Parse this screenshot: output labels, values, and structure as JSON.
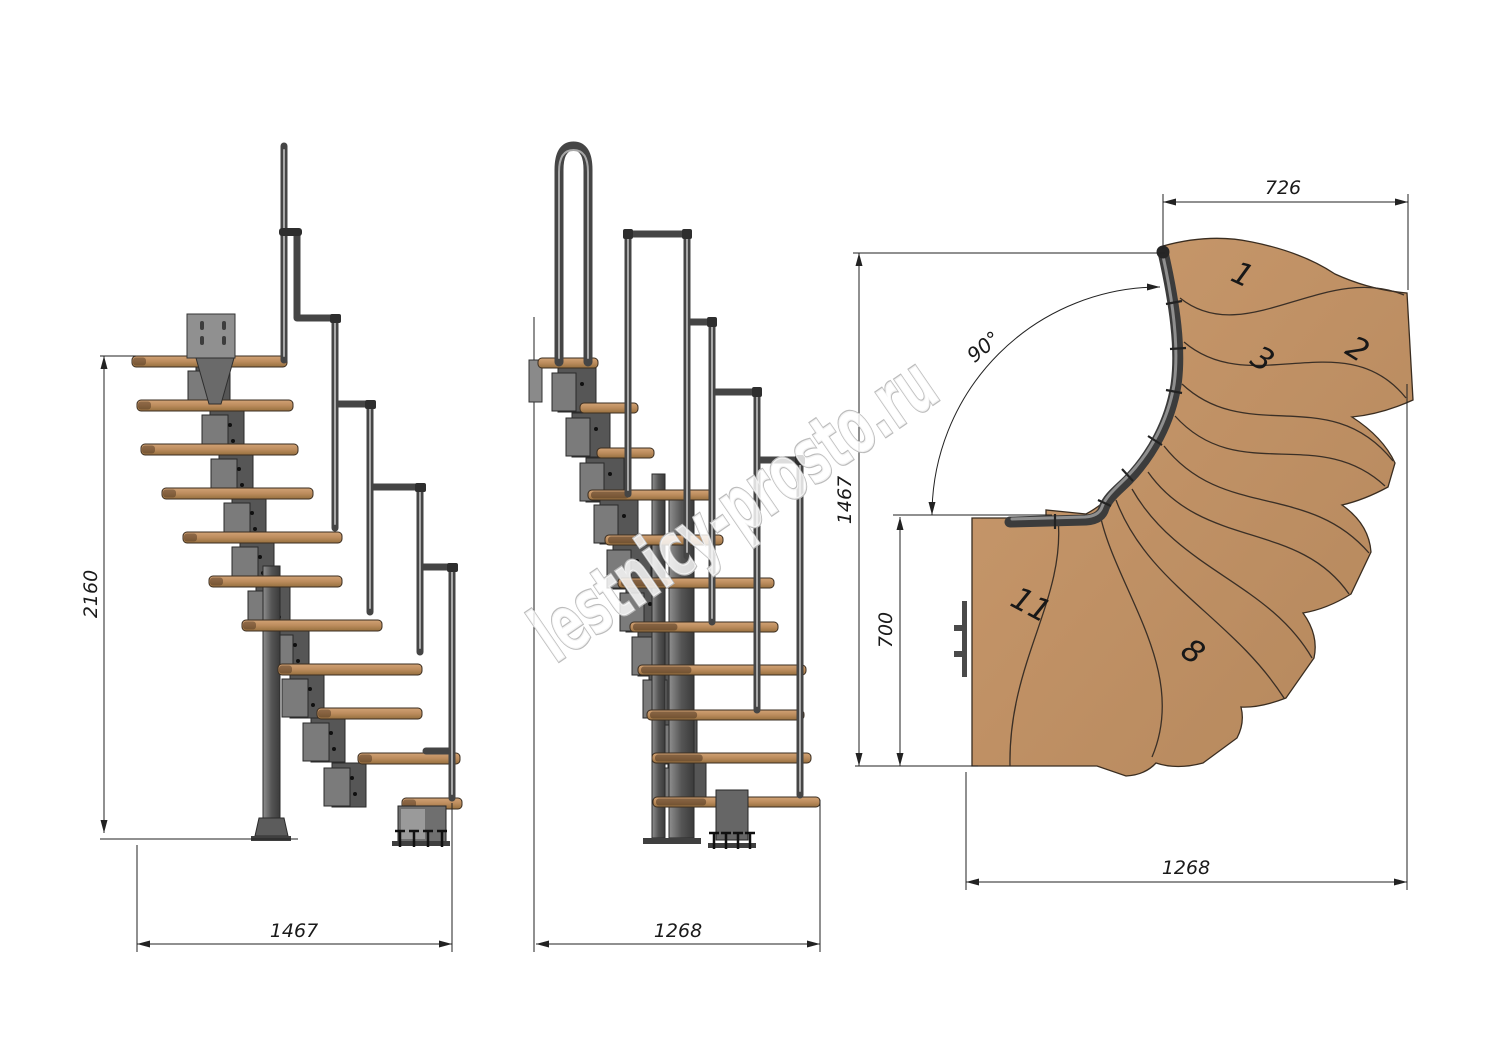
{
  "watermark": {
    "text": "lestnicy-prosto.ru"
  },
  "side_view": {
    "height_dim": "2160",
    "width_dim": "1467"
  },
  "front_view": {
    "width_dim": "1268"
  },
  "plan_view": {
    "top_width_dim": "726",
    "overall_depth_dim": "1467",
    "landing_width_dim": "700",
    "overall_width_dim": "1268",
    "turn_angle_label": "90°",
    "step_numbers": [
      "1",
      "2",
      "3",
      "8",
      "11"
    ]
  }
}
